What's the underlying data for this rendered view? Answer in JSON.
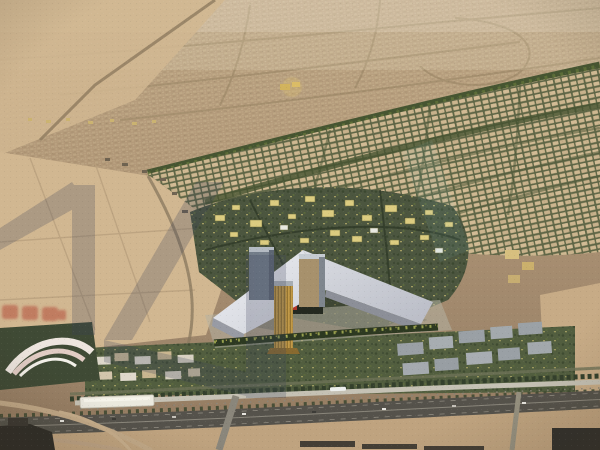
{
  "meta": {
    "type": "architectural-aerial-render",
    "time_of_day": "dusk",
    "alt": "Bird's-eye dusk rendering of a desert city masterplan: central three-tower landmark complex on a white winged podium, surrounded by low-rise districts and tree-lined boulevards, with an elevated metro line, a station and a multi-lane highway in the foreground; tan city fabric fades into haze at the horizon; translucent slate watermark glyphs and a small illegible red watermark overlay the left side"
  },
  "palette": {
    "haze_sky": "#cfbb9d",
    "distant_city": "#b19674",
    "street_tan": "#97825f",
    "desert_sand": "#d3b78f",
    "sand_shadow": "#b99b78",
    "green_district": "#4b563e",
    "boulevard_green": "#45552f",
    "lit_building_yellow": "#decd7d",
    "residential_beige": "#c2a982",
    "podium_white": "#e3e4e8",
    "podium_shade": "#989ba5",
    "tower_gray": "#727d8a",
    "tower_tan": "#a8916a",
    "tower_gold": "#c49a44",
    "logo_red": "#b33327",
    "metro_concrete": "#c6c2b4",
    "station_white": "#eceadf",
    "highway_asphalt": "#55524a",
    "foreground_sand": "#c1a37d",
    "silhouette_dark": "#2e2c27",
    "watermark_slate": "#39415a",
    "watermark_red": "#b5402e"
  },
  "landmarks": {
    "complex_label": "central-three-tower-complex",
    "station_label": "elevated-metro-station",
    "highway_label": "foreground-highway",
    "boulevard_label": "diagonal-tree-lined-boulevard",
    "watermark_note": "illegible-red-watermark-text"
  }
}
